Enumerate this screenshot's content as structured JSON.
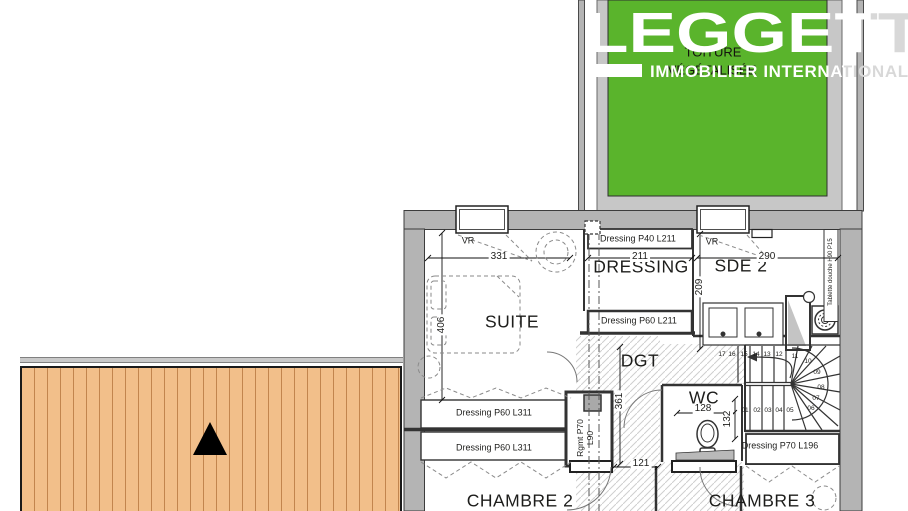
{
  "logo": {
    "brand": "LEGGETT",
    "tagline": "IMMOBILIER INTERNATIONAL"
  },
  "roof": {
    "line1": "TOITURE",
    "line2": "VÉGÉTALISÉE"
  },
  "rooms": {
    "suite": "SUITE",
    "dressing": "DRESSING",
    "sde2": "SDE 2",
    "dgt": "DGT",
    "wc": "WC",
    "chambre2": "CHAMBRE 2",
    "chambre3": "CHAMBRE 3"
  },
  "closets": {
    "p40_l211": "Dressing P40 L211",
    "p60_l211": "Dressing P60 L211",
    "p60_l311": "Dressing P60 L311",
    "p70_l196": "Dressing P70 L196",
    "rgmt": "Rgmt P70 L90",
    "tablette": "Tablette douche H90 P15"
  },
  "misc": {
    "vr": "VR"
  },
  "dimensions": {
    "suite_width": "331",
    "suite_height": "406",
    "dressing_width": "211",
    "sde2_width": "290",
    "sde2_height": "209",
    "dgt_height": "361",
    "hall_width": "121",
    "wc_width": "128",
    "wc_height": "132"
  },
  "stairs": {
    "steps": [
      "01",
      "02",
      "03",
      "04",
      "05",
      "06",
      "07",
      "08",
      "09",
      "10",
      "11",
      "12",
      "13",
      "14",
      "15",
      "16",
      "17"
    ]
  },
  "colors": {
    "roof_green": "#5ab42c",
    "terrace_orange": "#f2bf8a",
    "plank_line": "#c2854e",
    "wall_gray": "#b4b4b4",
    "surround_gray": "#c7c7c7",
    "text_dark": "#1d1d1b",
    "logo_white": "#ffffff",
    "logo_gray": "#d8d8d8"
  }
}
